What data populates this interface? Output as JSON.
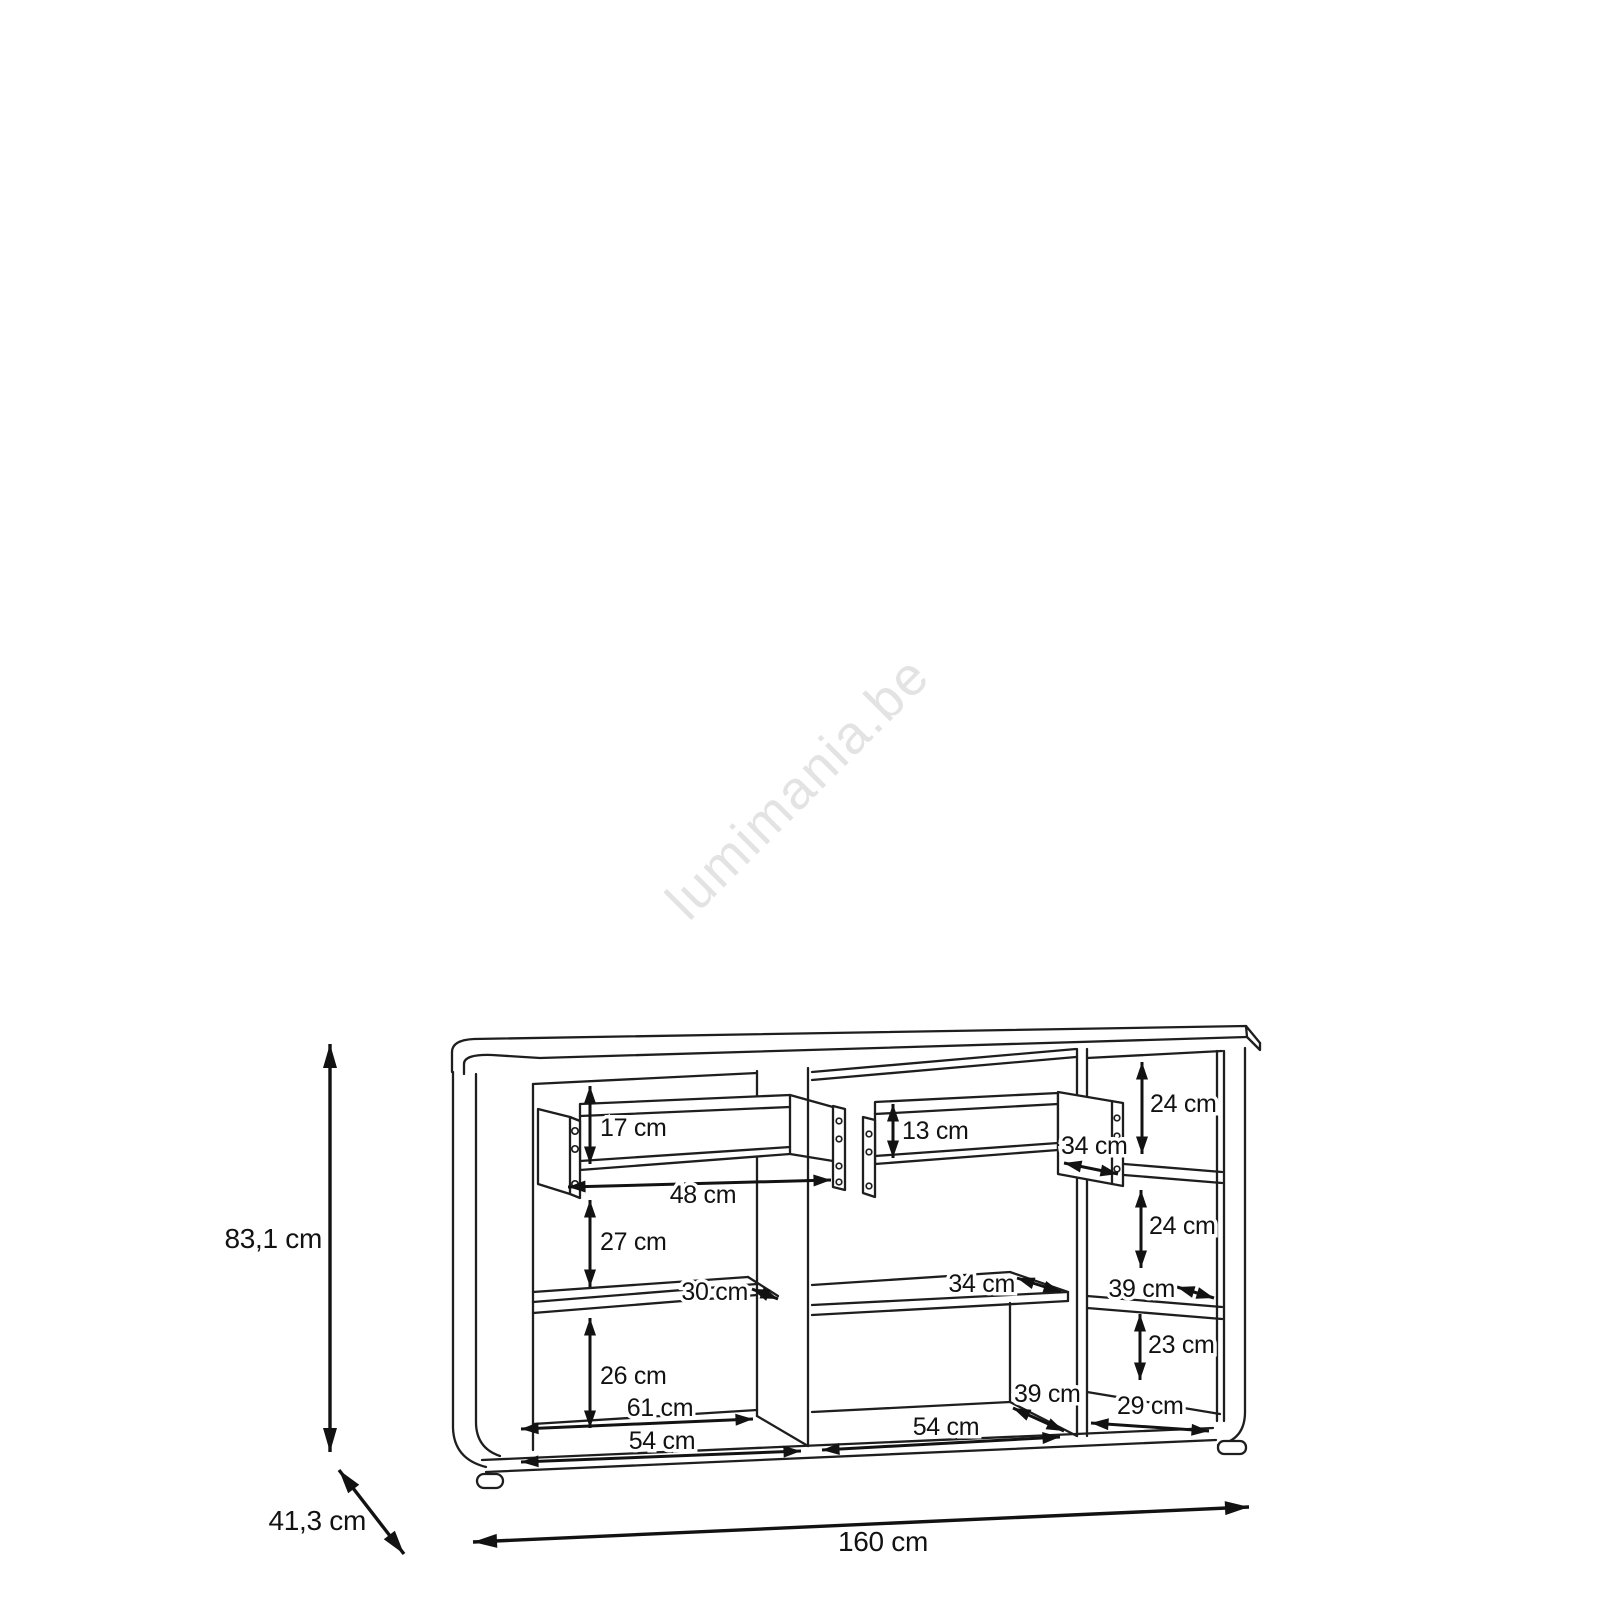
{
  "watermark": {
    "text": "lumimania.be",
    "color": "#e3e3e3"
  },
  "diagram": {
    "units": "cm",
    "dimensions": {
      "left_drawer_front_height": "17 cm",
      "middle_drawer_front_height": "13 cm",
      "left_drawer_width": "48 cm",
      "middle_drawer_side_depth": "34 cm",
      "left_middle_section_height": "27 cm",
      "left_shelf_depth": "30 cm",
      "middle_shelf_depth": "34 cm",
      "right_top_section_height": "24 cm",
      "right_middle_section_height": "24 cm",
      "right_shelf_depth": "39 cm",
      "right_bottom_section_height": "23 cm",
      "right_section_width": "29 cm",
      "left_bottom_section_height": "26 cm",
      "left_section_back_width": "61 cm",
      "left_section_front_width": "54 cm",
      "middle_section_front_width": "54 cm",
      "middle_floor_depth": "39 cm",
      "overall_height": "83,1 cm",
      "overall_depth": "41,3 cm",
      "overall_width": "160 cm"
    }
  }
}
